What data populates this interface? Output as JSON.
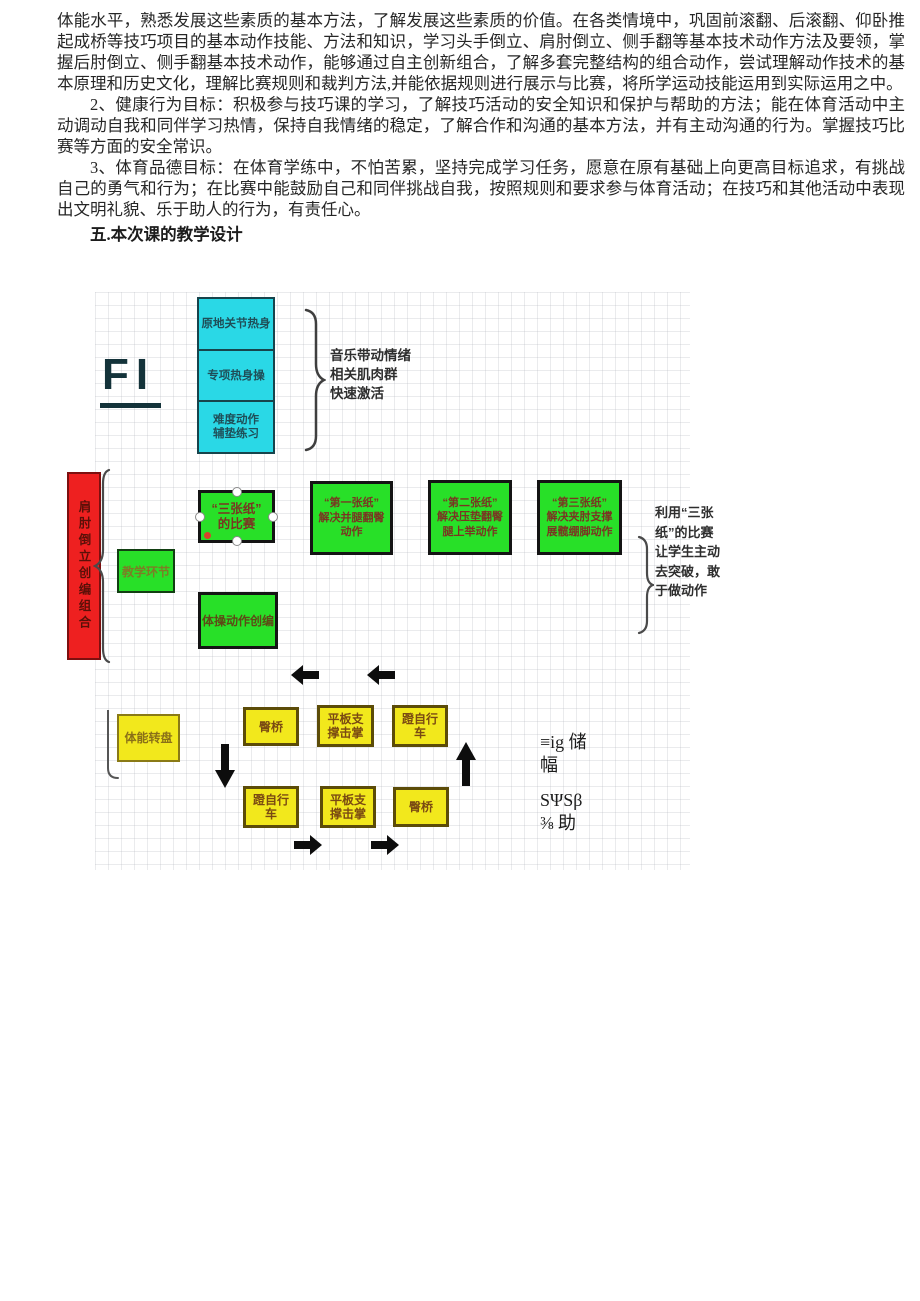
{
  "document": {
    "paragraphs": [
      {
        "text": "体能水平，熟悉发展这些素质的基本方法，了解发展这些素质的价值。在各类情境中，巩固前滚翻、后滚翻、仰卧推起成桥等技巧项目的基本动作技能、方法和知识，学习头手倒立、肩肘倒立、侧手翻等基本技术动作方法及要领，掌握后肘倒立、侧手翻基本技术动作，能够通过自主创新组合，了解多套完整结构的组合动作，尝试理解动作技术的基本原理和历史文化，理解比赛规则和裁判方法,并能依据规则进行展示与比赛，将所学运动技能运用到实际运用之中。"
      },
      {
        "text": "2、健康行为目标：积极参与技巧课的学习，了解技巧活动的安全知识和保护与帮助的方法；能在体育活动中主动调动自我和同伴学习热情，保持自我情绪的稳定，了解合作和沟通的基本方法，并有主动沟通的行为。掌握技巧比赛等方面的安全常识。"
      },
      {
        "text": "3、体育品德目标：在体育学练中，不怕苦累，坚持完成学习任务，愿意在原有基础上向更高目标追求，有挑战自己的勇气和行为；在比赛中能鼓励自己和同伴挑战自我，按照规则和要求参与体育活动；在技巧和其他活动中表现出文明礼貌、乐于助人的行为，有责任心。"
      }
    ],
    "heading": "五.本次课的教学设计"
  },
  "diagram": {
    "figure_label": "FI",
    "warmup": {
      "box1": "原地关节热身",
      "box2": "专项热身操",
      "box3_line1": "难度动作",
      "box3_line2": "辅垫练习",
      "note_line1": "音乐带动情绪",
      "note_line2": "相关肌肉群",
      "note_line3": "快速激活"
    },
    "phase_label": "肩肘倒立创编组合",
    "teaching_box": "教学环节",
    "contest_box": {
      "line1": "“三张纸”",
      "line2": "的比赛"
    },
    "paper_boxes": [
      {
        "line1": "“第一张纸”",
        "line2": "解决并腿翻臀",
        "line3": "动作"
      },
      {
        "line1": "“第二张纸”",
        "line2": "解决压垫翻臀",
        "line3": "腿上举动作"
      },
      {
        "line1": "“第三张纸”",
        "line2": "解决夹肘支撑",
        "line3": "展髋绷脚动作"
      }
    ],
    "paper_note": {
      "line1": "利用“三张",
      "line2": "纸”的比赛",
      "line3": "让学生主动",
      "line4": "去突破，敢",
      "line5": "于做动作"
    },
    "creative_box": "体操动作创编",
    "fitness_box": "体能转盘",
    "circuit": {
      "top1": "臀桥",
      "top2_line1": "平板支",
      "top2_line2": "撑击掌",
      "top3_line1": "蹬自行",
      "top3_line2": "车",
      "bottom1_line1": "蹬自行",
      "bottom1_line2": "车",
      "bottom2_line1": "平板支",
      "bottom2_line2": "撑击掌",
      "bottom3": "臀桥"
    },
    "ocr_artifacts": {
      "line1": "≡ig 储",
      "line2": "幅",
      "line3": "SΨSβ",
      "line4": "⅜ 助"
    }
  },
  "colors": {
    "warmup_cyan": "#2ad8e6",
    "box_green": "#28e028",
    "phase_red": "#ee2020",
    "circuit_yellow": "#f2e81c"
  }
}
